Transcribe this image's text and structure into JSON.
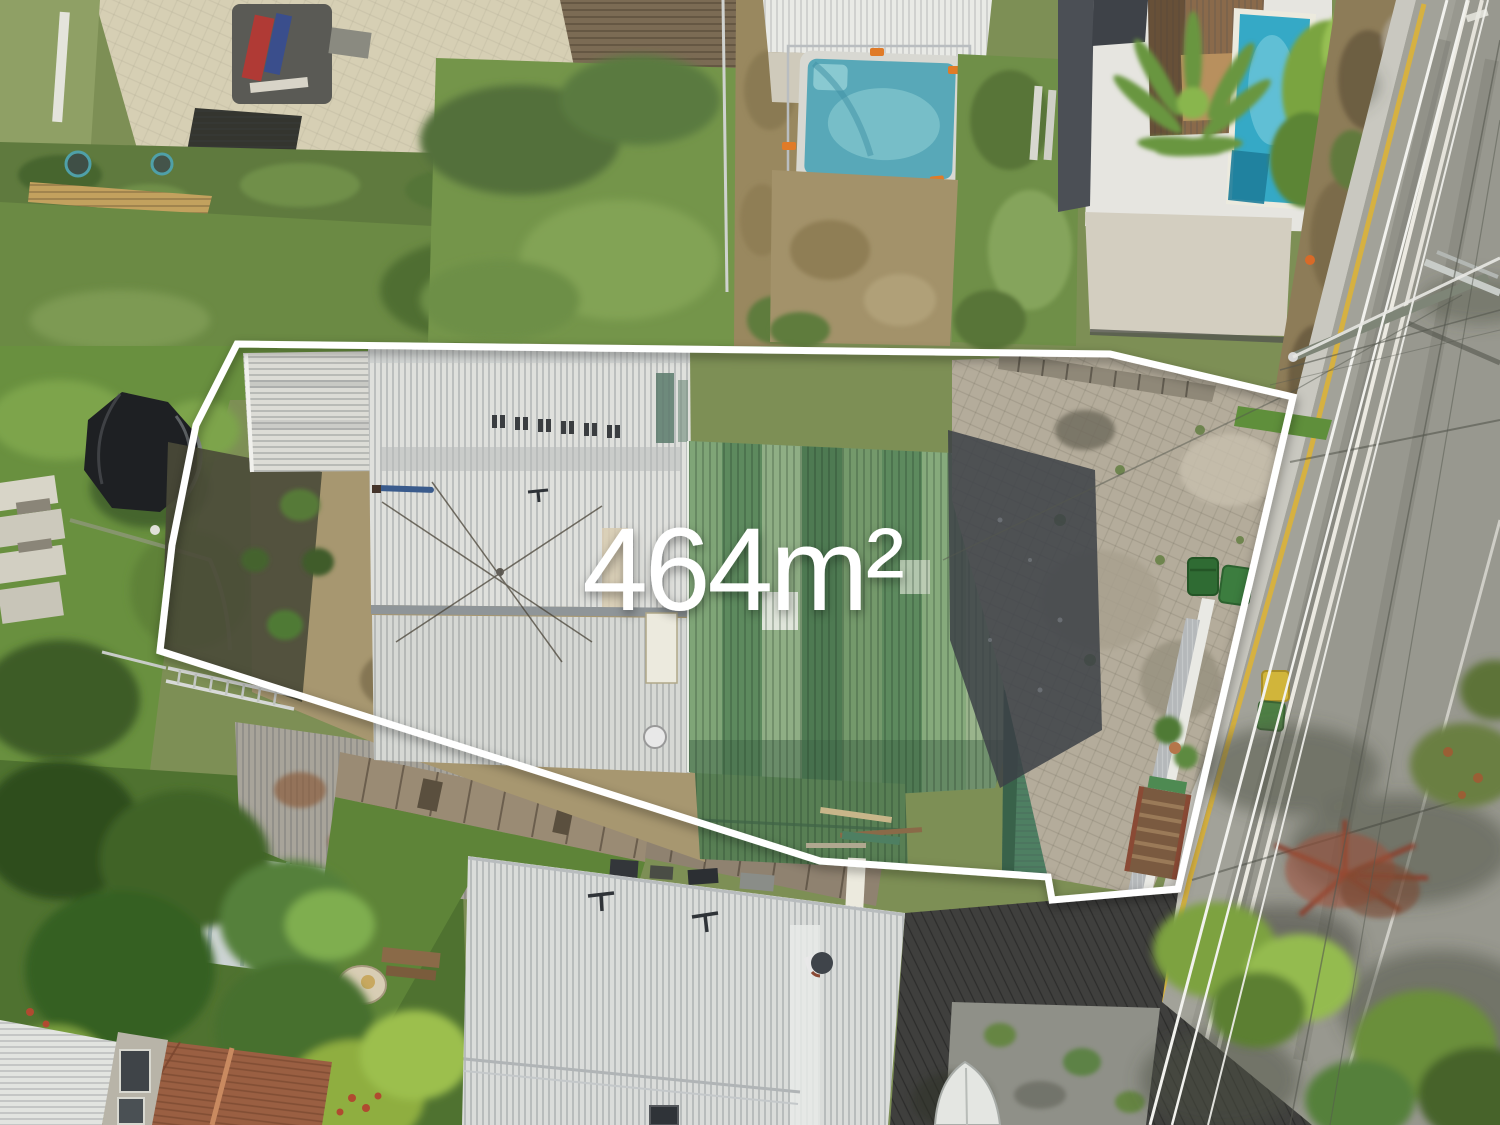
{
  "overlay": {
    "area_label": "464m²"
  },
  "colors": {
    "boundary": "#ffffff",
    "label": "#ffffff",
    "road_surface": "#98988f",
    "road_yellow_line": "#d9b23c",
    "road_white_line": "#eceae2",
    "pool_water_main": "#35a9c6",
    "pool_water_small": "#58a8b8",
    "main_roof_white": "#dfe0dc",
    "main_roof_green": "#6d9267",
    "big_roof_white": "#dadcda",
    "terracotta_roof": "#9a5f42",
    "lawn_green": "#6b8f44",
    "dirt_courtyard": "#a79770"
  },
  "scene": {
    "description": "Aerial drone photo of a residential block outlined in white with area label"
  }
}
